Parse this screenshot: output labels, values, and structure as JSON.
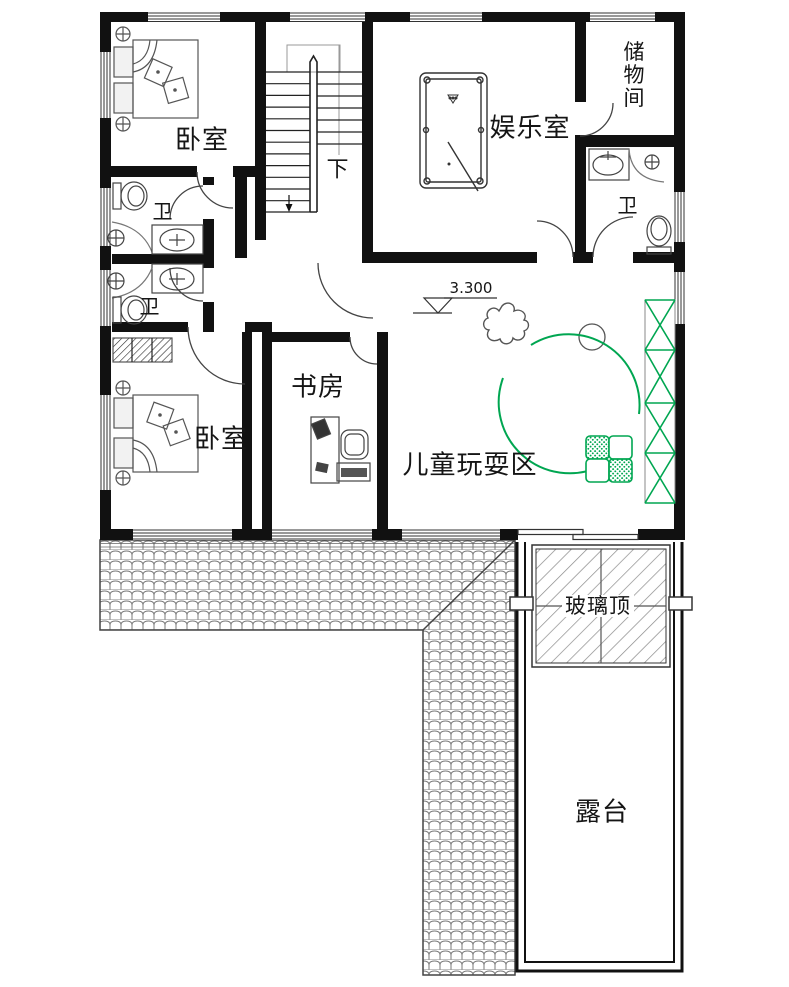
{
  "plan": {
    "rooms": [
      {
        "id": "bedroom-top",
        "label": "卧室"
      },
      {
        "id": "entertainment",
        "label": "娱乐室"
      },
      {
        "id": "storage",
        "label": "储物间"
      },
      {
        "id": "bath-right",
        "label": "卫"
      },
      {
        "id": "bath-left-upper",
        "label": "卫"
      },
      {
        "id": "bath-left-lower",
        "label": "卫"
      },
      {
        "id": "bedroom-bottom",
        "label": "卧室"
      },
      {
        "id": "study",
        "label": "书房"
      },
      {
        "id": "play-area",
        "label": "儿童玩耍区"
      },
      {
        "id": "glass-roof",
        "label": "玻璃顶"
      },
      {
        "id": "terrace",
        "label": "露台"
      }
    ],
    "annotations": {
      "stairs_direction": "下",
      "elevation": "3.300"
    },
    "colors": {
      "wall": "#111111",
      "line": "#555555",
      "accent_green": "#00a651"
    }
  }
}
